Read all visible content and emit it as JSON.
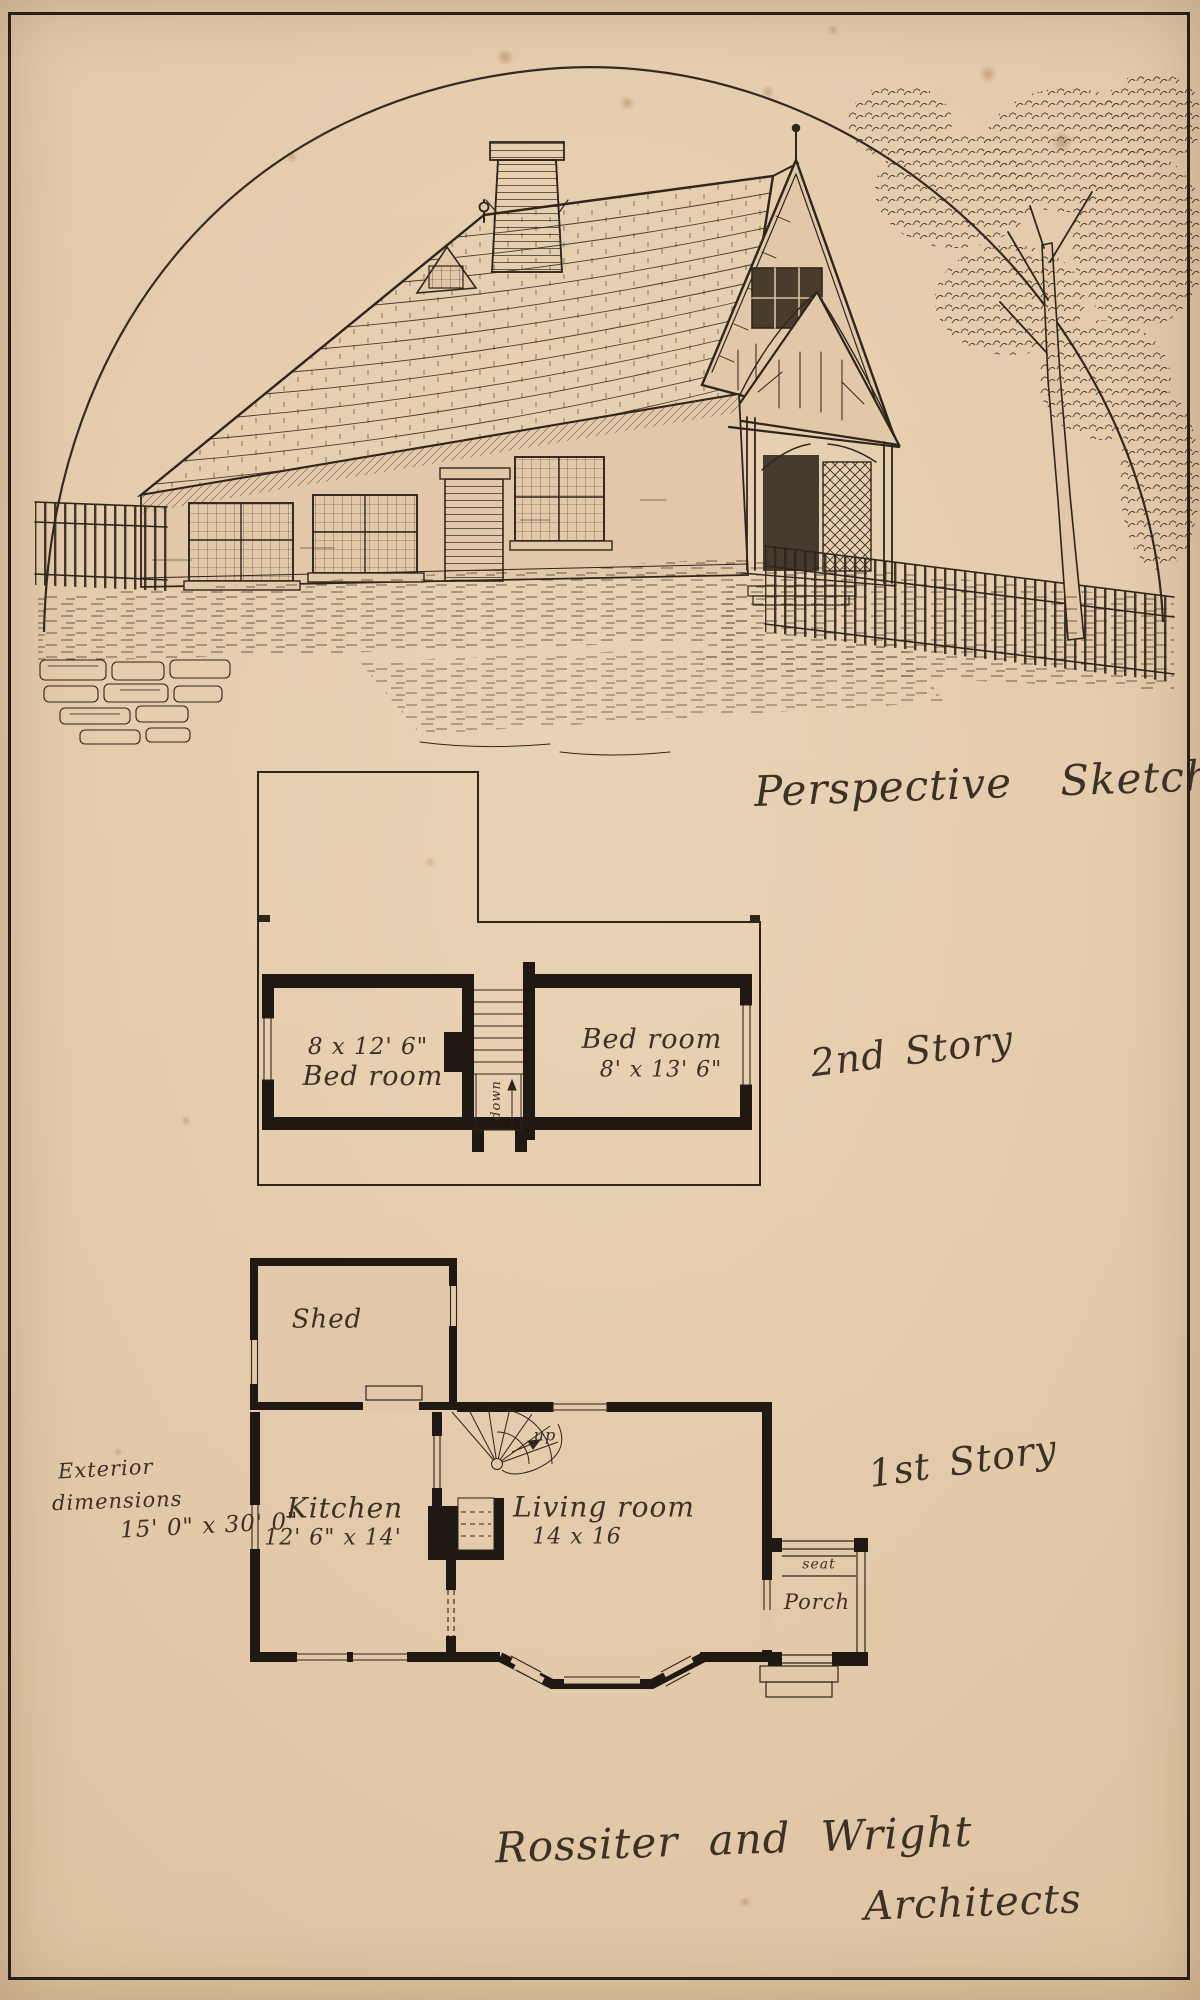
{
  "page": {
    "type": "scanned architectural plate",
    "paper_color": "#e2c8a9",
    "ink_color": "#2e251b",
    "wall_color": "#201913"
  },
  "sketch": {
    "caption": "Perspective Sketch"
  },
  "second_story": {
    "title": "2nd Story",
    "left_bedroom": {
      "dims": "8 x 12' 6\"",
      "name": "Bed room"
    },
    "right_bedroom": {
      "name": "Bed room",
      "dims": "8' x 13' 6\""
    },
    "stair_label": "down"
  },
  "first_story": {
    "title": "1st Story",
    "shed": "Shed",
    "kitchen": {
      "name": "Kitchen",
      "dims": "12' 6\" x 14'"
    },
    "living_room": {
      "name": "Living room",
      "dims": "14 x 16"
    },
    "stair_label": "up",
    "porch": {
      "seat": "seat",
      "name": "Porch"
    },
    "exterior_note": {
      "line1": "Exterior",
      "line2": "dimensions",
      "line3": "15' 0\" x 30' 0\""
    }
  },
  "footer": {
    "firm": "Rossiter and Wright",
    "role": "Architects"
  }
}
